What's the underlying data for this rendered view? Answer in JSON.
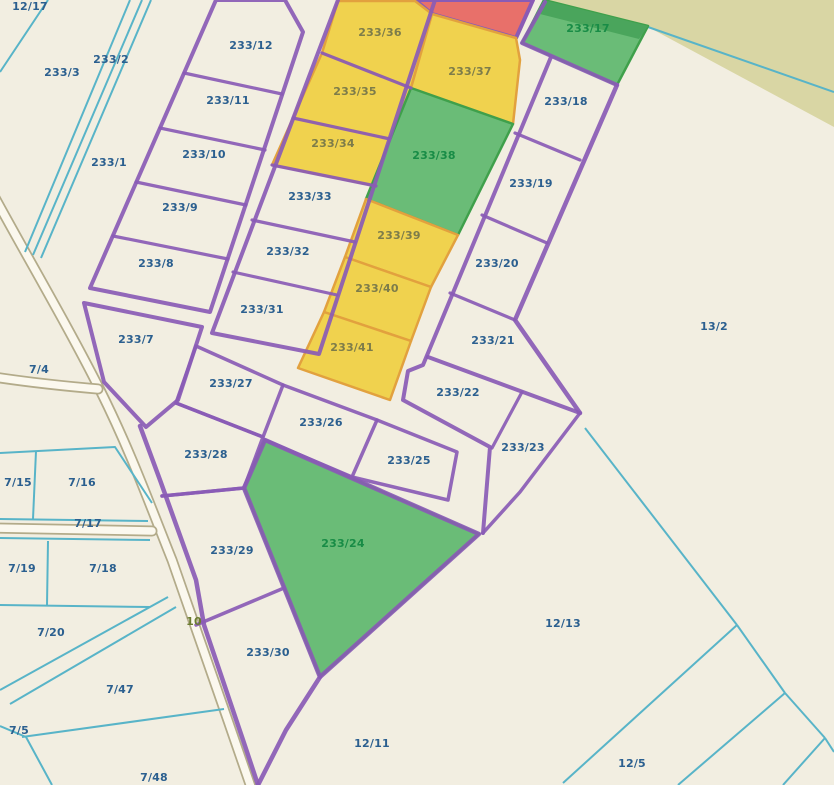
{
  "map": {
    "title": "cadastral-parcel-map",
    "background": "#f2eee1",
    "colors": {
      "olive_area": "#d9d6a4",
      "purple_line": "#8a5bb5",
      "purple_thick": "#7e4fa8",
      "cyan_line": "#58b4c8",
      "yellow_fill": "#f0d24e",
      "yellow_stroke": "#e2a13e",
      "green_fill": "#6abc77",
      "green_stroke": "#3fa04b",
      "green_band": "#4aa55c",
      "red_fill": "#e8706a",
      "road_casing": "#b3ab8a",
      "road_fill": "#fbf8ee",
      "label_navy": "#2b5f8f",
      "label_olive": "#7d7c4a",
      "label_green": "#188c46",
      "label_road": "#6b7c30"
    },
    "olive_area_points": "544,0 834,0 834,127 650,28",
    "roads": [
      {
        "name": "road-main",
        "d": "M-6,196 C30,262 70,330 100,390 C130,450 150,505 172,560 C195,625 225,712 252,790"
      },
      {
        "name": "road-branch-7-4",
        "d": "M-6,377 Q40,384 98,389"
      },
      {
        "name": "road-branch-7-17",
        "d": "M-6,528 L152,531"
      }
    ],
    "zones": [
      {
        "id": "zone-red",
        "kind": "red",
        "points": "415,0 533,0 516,38 432,14"
      },
      {
        "id": "zone-233-36",
        "kind": "yellow",
        "points": "338,1 415,1 432,14 411,88 322,53"
      },
      {
        "id": "zone-233-37",
        "kind": "yellow",
        "points": "432,14 516,38 520,60 513,124 411,88"
      },
      {
        "id": "zone-233-35",
        "kind": "yellow",
        "points": "322,53 411,88 390,139 293,118"
      },
      {
        "id": "zone-233-34",
        "kind": "yellow",
        "points": "293,118 390,139 376,186 272,165"
      },
      {
        "id": "zone-233-38",
        "kind": "green",
        "points": "411,88 513,124 458,235 366,199"
      },
      {
        "id": "zone-233-39",
        "kind": "yellow",
        "points": "366,199 458,235 431,287 345,257"
      },
      {
        "id": "zone-233-40",
        "kind": "yellow",
        "points": "345,257 431,287 411,341 324,312"
      },
      {
        "id": "zone-233-41",
        "kind": "yellow",
        "points": "324,312 411,341 390,400 298,368"
      },
      {
        "id": "zone-233-17",
        "kind": "green",
        "points": "522,43 544,0 648,26 617,85"
      },
      {
        "id": "zone-233-17-band",
        "kind": "greenband",
        "points": "544,0 648,26 639,39 536,13"
      },
      {
        "id": "zone-233-24",
        "kind": "green",
        "points": "265,440 479,534 320,677 244,488"
      }
    ],
    "purple_lines": [
      {
        "d": "M216,0 L285,0 L303,32 L210,312 L90,288 Z",
        "w": 4
      },
      {
        "d": "M184,73 L282,94",
        "w": 3.2
      },
      {
        "d": "M160,128 L265,150",
        "w": 3.2
      },
      {
        "d": "M136,182 L246,205",
        "w": 3.2
      },
      {
        "d": "M113,236 L228,259",
        "w": 3.2
      },
      {
        "d": "M338,0 L212,333 L319,354 L435,0",
        "w": 4
      },
      {
        "d": "M322,53 L411,88",
        "w": 3.2
      },
      {
        "d": "M293,118 L390,139",
        "w": 3.2
      },
      {
        "d": "M272,165 L376,186",
        "w": 3.2
      },
      {
        "d": "M252,220 L355,242",
        "w": 3.2
      },
      {
        "d": "M233,272 L337,295",
        "w": 3.2
      },
      {
        "d": "M545,2 L522,43 L617,85",
        "w": 4
      },
      {
        "d": "M551,57 L423,365 L408,371 L403,400 L490,447 L483,533",
        "w": 4
      },
      {
        "d": "M617,85 L515,320 L580,413",
        "w": 4.5
      },
      {
        "d": "M515,133 L580,160",
        "w": 3.2
      },
      {
        "d": "M482,215 L547,243",
        "w": 3.2
      },
      {
        "d": "M450,293 L515,320",
        "w": 3.2
      },
      {
        "d": "M428,357 L580,413",
        "w": 4
      },
      {
        "d": "M522,392 L492,448",
        "w": 3.2
      },
      {
        "d": "M580,413 L520,492 L483,533",
        "w": 3.5
      },
      {
        "d": "M196,346 L283,385 L263,437 L176,403 Z",
        "w": 3.5
      },
      {
        "d": "M283,385 L377,420 L352,477 L265,440",
        "w": 3.5
      },
      {
        "d": "M377,420 L457,452 L448,500 L352,477",
        "w": 3.5
      },
      {
        "d": "M176,403 L263,437 L244,488 L162,496",
        "w": 3.5
      },
      {
        "d": "M162,496 L244,488",
        "w": 3.5
      },
      {
        "d": "M196,625 L284,588",
        "w": 3.5
      },
      {
        "d": "M265,440 L479,534 L320,677 L244,488 Z",
        "w": 4.5
      },
      {
        "d": "M140,426 L160,480 L178,530 L196,580 L204,625 L222,678 L243,740 L258,785",
        "w": 4.5
      },
      {
        "d": "M320,677 L286,730 L258,785",
        "w": 4.5
      },
      {
        "d": "M84,303 L202,327 L178,400 L146,427 L104,382 Z",
        "w": 4
      }
    ],
    "cyan_lines": [
      {
        "d": "M48,0 L0,72"
      },
      {
        "d": "M130,0 L25,252"
      },
      {
        "d": "M142,0 L33,255"
      },
      {
        "d": "M151,0 L41,258"
      },
      {
        "d": "M648,27 L834,92"
      },
      {
        "d": "M0,453 L115,447 L152,503"
      },
      {
        "d": "M36,451 L33,519"
      },
      {
        "d": "M0,519 L148,521"
      },
      {
        "d": "M0,538 L150,540"
      },
      {
        "d": "M48,541 L47,605"
      },
      {
        "d": "M0,605 L150,607"
      },
      {
        "d": "M0,690 L168,597"
      },
      {
        "d": "M10,704 L176,607"
      },
      {
        "d": "M22,737 L224,709"
      },
      {
        "d": "M0,726 L26,737 L52,785"
      },
      {
        "d": "M585,428 L737,625"
      },
      {
        "d": "M737,625 L563,783"
      },
      {
        "d": "M737,625 L785,693"
      },
      {
        "d": "M785,693 L678,785"
      },
      {
        "d": "M785,693 L825,738"
      },
      {
        "d": "M825,738 L783,785"
      },
      {
        "d": "M825,738 L834,752"
      }
    ],
    "parcel_labels": [
      {
        "text": "12/17",
        "x": 30,
        "y": 7,
        "c": "navy"
      },
      {
        "text": "233/3",
        "x": 62,
        "y": 73,
        "c": "navy"
      },
      {
        "text": "233/2",
        "x": 111,
        "y": 60,
        "c": "navy"
      },
      {
        "text": "233/1",
        "x": 109,
        "y": 163,
        "c": "navy"
      },
      {
        "text": "233/12",
        "x": 251,
        "y": 46,
        "c": "navy"
      },
      {
        "text": "233/11",
        "x": 228,
        "y": 101,
        "c": "navy"
      },
      {
        "text": "233/10",
        "x": 204,
        "y": 155,
        "c": "navy"
      },
      {
        "text": "233/9",
        "x": 180,
        "y": 208,
        "c": "navy"
      },
      {
        "text": "233/8",
        "x": 156,
        "y": 264,
        "c": "navy"
      },
      {
        "text": "233/7",
        "x": 136,
        "y": 340,
        "c": "navy"
      },
      {
        "text": "7/4",
        "x": 39,
        "y": 370,
        "c": "navy"
      },
      {
        "text": "233/36",
        "x": 380,
        "y": 33,
        "c": "olive"
      },
      {
        "text": "233/37",
        "x": 470,
        "y": 72,
        "c": "olive"
      },
      {
        "text": "233/35",
        "x": 355,
        "y": 92,
        "c": "olive"
      },
      {
        "text": "233/34",
        "x": 333,
        "y": 144,
        "c": "olive"
      },
      {
        "text": "233/33",
        "x": 310,
        "y": 197,
        "c": "navy"
      },
      {
        "text": "233/32",
        "x": 288,
        "y": 252,
        "c": "navy"
      },
      {
        "text": "233/31",
        "x": 262,
        "y": 310,
        "c": "navy"
      },
      {
        "text": "233/38",
        "x": 434,
        "y": 156,
        "c": "green"
      },
      {
        "text": "233/39",
        "x": 399,
        "y": 236,
        "c": "olive"
      },
      {
        "text": "233/40",
        "x": 377,
        "y": 289,
        "c": "olive"
      },
      {
        "text": "233/41",
        "x": 352,
        "y": 348,
        "c": "olive"
      },
      {
        "text": "233/17",
        "x": 588,
        "y": 29,
        "c": "green"
      },
      {
        "text": "233/18",
        "x": 566,
        "y": 102,
        "c": "navy"
      },
      {
        "text": "233/19",
        "x": 531,
        "y": 184,
        "c": "navy"
      },
      {
        "text": "233/20",
        "x": 497,
        "y": 264,
        "c": "navy"
      },
      {
        "text": "233/21",
        "x": 493,
        "y": 341,
        "c": "navy"
      },
      {
        "text": "13/2",
        "x": 714,
        "y": 327,
        "c": "navy"
      },
      {
        "text": "233/27",
        "x": 231,
        "y": 384,
        "c": "navy"
      },
      {
        "text": "233/26",
        "x": 321,
        "y": 423,
        "c": "navy"
      },
      {
        "text": "233/22",
        "x": 458,
        "y": 393,
        "c": "navy"
      },
      {
        "text": "233/25",
        "x": 409,
        "y": 461,
        "c": "navy"
      },
      {
        "text": "233/23",
        "x": 523,
        "y": 448,
        "c": "navy"
      },
      {
        "text": "233/28",
        "x": 206,
        "y": 455,
        "c": "navy"
      },
      {
        "text": "7/15",
        "x": 18,
        "y": 483,
        "c": "navy"
      },
      {
        "text": "7/16",
        "x": 82,
        "y": 483,
        "c": "navy"
      },
      {
        "text": "7/17",
        "x": 88,
        "y": 524,
        "c": "navy"
      },
      {
        "text": "233/29",
        "x": 232,
        "y": 551,
        "c": "navy"
      },
      {
        "text": "233/24",
        "x": 343,
        "y": 544,
        "c": "green"
      },
      {
        "text": "7/19",
        "x": 22,
        "y": 569,
        "c": "navy"
      },
      {
        "text": "7/18",
        "x": 103,
        "y": 569,
        "c": "navy"
      },
      {
        "text": "7/20",
        "x": 51,
        "y": 633,
        "c": "navy"
      },
      {
        "text": "10",
        "x": 194,
        "y": 622,
        "c": "road"
      },
      {
        "text": "12/13",
        "x": 563,
        "y": 624,
        "c": "navy"
      },
      {
        "text": "233/30",
        "x": 268,
        "y": 653,
        "c": "navy"
      },
      {
        "text": "7/47",
        "x": 120,
        "y": 690,
        "c": "navy"
      },
      {
        "text": "7/5",
        "x": 19,
        "y": 731,
        "c": "navy"
      },
      {
        "text": "12/11",
        "x": 372,
        "y": 744,
        "c": "navy"
      },
      {
        "text": "12/5",
        "x": 632,
        "y": 764,
        "c": "navy"
      },
      {
        "text": "7/48",
        "x": 154,
        "y": 778,
        "c": "navy"
      }
    ]
  }
}
